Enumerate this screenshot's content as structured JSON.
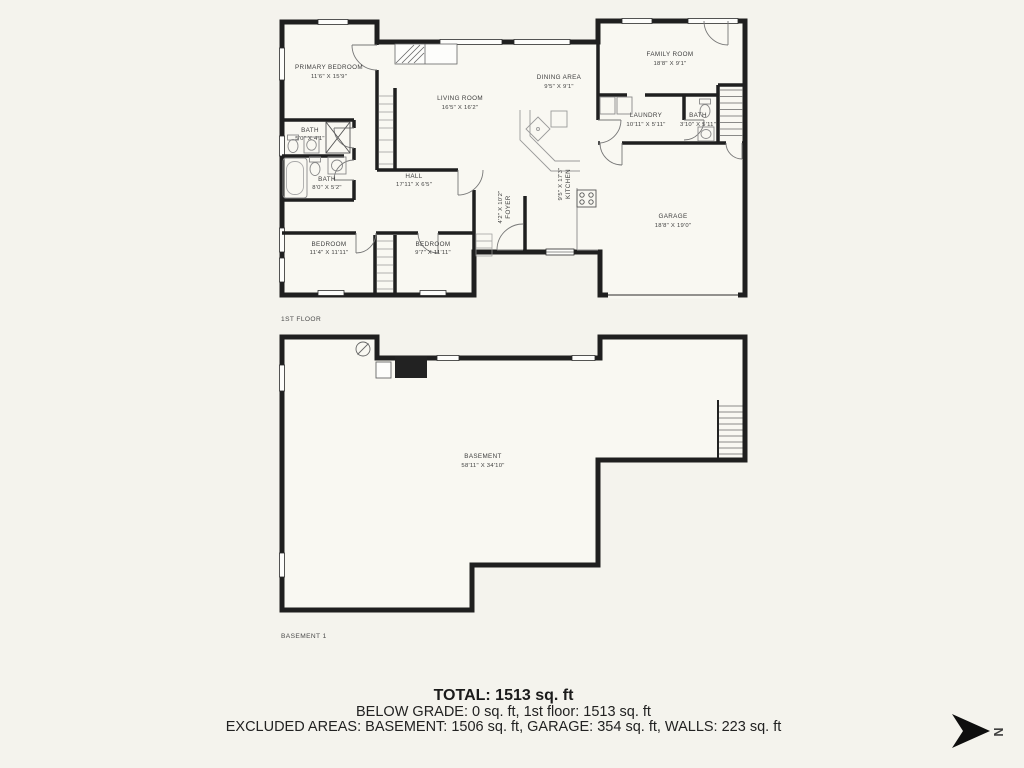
{
  "page": {
    "background": "#f4f3ed",
    "wall_color": "#1f1f1f",
    "text_color": "#3e3e3e"
  },
  "floors": {
    "first": {
      "label": "1ST FLOOR",
      "rooms": {
        "primary_bedroom": {
          "name": "PRIMARY BEDROOM",
          "dims": "11'6\" X 15'9\""
        },
        "living_room": {
          "name": "LIVING ROOM",
          "dims": "16'5\" X 16'2\""
        },
        "dining_area": {
          "name": "DINING AREA",
          "dims": "9'5\" X 9'1\""
        },
        "family_room": {
          "name": "FAMILY ROOM",
          "dims": "18'8\" X 9'1\""
        },
        "laundry": {
          "name": "LAUNDRY",
          "dims": "10'11\" X 5'11\""
        },
        "bath_hall": {
          "name": "BATH",
          "dims": "3'10\" X 5'11\""
        },
        "bath_primary": {
          "name": "BATH",
          "dims": "5'0\" X 4'1\""
        },
        "bath_main": {
          "name": "BATH",
          "dims": "8'0\" X 5'2\""
        },
        "hall": {
          "name": "HALL",
          "dims": "17'11\" X 6'5\""
        },
        "kitchen": {
          "name": "KITCHEN",
          "dims": "9'5\" X 17'3\""
        },
        "foyer": {
          "name": "FOYER",
          "dims": "4'2\" X 10'2\""
        },
        "bedroom_one": {
          "name": "BEDROOM",
          "dims": "11'4\" X 11'11\""
        },
        "bedroom_two": {
          "name": "BEDROOM",
          "dims": "9'7\" X 11'11\""
        },
        "garage": {
          "name": "GARAGE",
          "dims": "18'8\" X 19'0\""
        }
      }
    },
    "basement": {
      "label": "BASEMENT 1",
      "room": {
        "name": "BASEMENT",
        "dims": "58'11\" X 34'10\""
      }
    }
  },
  "summary": {
    "total": "TOTAL: 1513 sq. ft",
    "below_grade": "BELOW GRADE: 0 sq. ft, 1st floor: 1513 sq. ft",
    "excluded_areas": "EXCLUDED AREAS: BASEMENT: 1506 sq. ft, GARAGE: 354 sq. ft, WALLS: 223 sq. ft"
  },
  "compass": {
    "direction": "N"
  }
}
